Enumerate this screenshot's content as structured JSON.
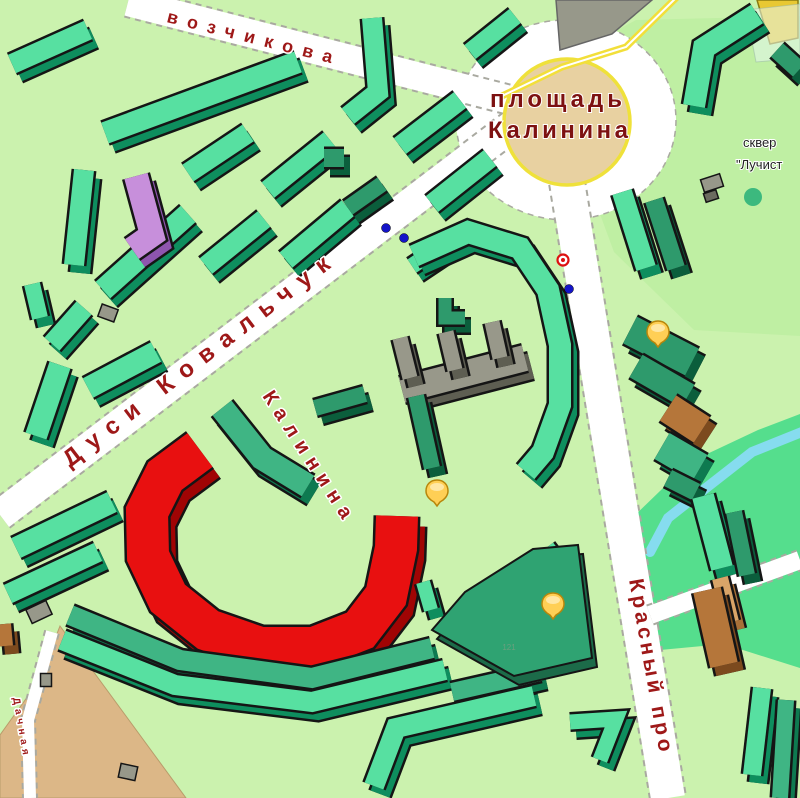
{
  "map": {
    "streets": [
      {
        "text": "возчикова"
      },
      {
        "text": "Дуси Ковальчук"
      },
      {
        "text": "Калинина"
      },
      {
        "text": "Красный про"
      },
      {
        "text": "Дачная"
      }
    ],
    "plaza": {
      "line1": "площадь",
      "line2": "Калинина"
    },
    "skver": {
      "line1": "сквер",
      "line2": "\"Лучист"
    },
    "stadium_number": "121",
    "markers": {
      "poi": [
        {
          "x": 437,
          "y": 492
        },
        {
          "x": 658,
          "y": 333
        },
        {
          "x": 553,
          "y": 605
        }
      ],
      "stops_blue": [
        {
          "x": 386,
          "y": 228
        },
        {
          "x": 404,
          "y": 238
        },
        {
          "x": 569,
          "y": 289
        }
      ],
      "stop_red": {
        "x": 563,
        "y": 260
      }
    },
    "colors": {
      "background": "#CBF2AE",
      "park_skver": "#BFEFA3",
      "park_bright": "#55DE8D",
      "stream": "#86DCEF",
      "sand_area": "#DCB787",
      "road_fill": "#FFFFFF",
      "road_edge": "#A9A9A0",
      "plaza_fill": "#E8D1A1",
      "plaza_ring": "#EFE13A",
      "tram_line": "#F2DF3A",
      "outline": "#151515",
      "gray_flat": "#97988A",
      "dark_square": "#6B6B5F",
      "tree": "#3CB97E",
      "marker_blue": "#1414C8",
      "marker_red": "#DD1111",
      "poi_fill": "#FFCF55",
      "poi_highlight": "#FFE9AD",
      "poi_stroke": "#B8860B",
      "street_text": "#9E1818",
      "plaza_text": "#7D1111",
      "skver_text": "#222222",
      "number_text": "#69A07E",
      "buildings": {
        "g": {
          "top": "#57E0A1",
          "side": "#0E8E5E"
        },
        "gm": {
          "top": "#3FB584",
          "side": "#0E7A50"
        },
        "gd": {
          "top": "#2E9A6C",
          "side": "#0B5E3C"
        },
        "gray": {
          "top": "#98988A",
          "side": "#5E5E52"
        },
        "pur": {
          "top": "#C78FDB",
          "side": "#8E55AE"
        },
        "br": {
          "top": "#B5763A",
          "side": "#7C4A1E"
        },
        "lbr": {
          "top": "#D9A468",
          "side": "#A87038"
        },
        "red": {
          "top": "#E81010",
          "side": "#A00404"
        },
        "stad": {
          "top": "#2FA372",
          "side": "#1C6B49"
        },
        "yellow": {
          "top": "#E8C832",
          "side": "#B09210"
        }
      }
    }
  }
}
